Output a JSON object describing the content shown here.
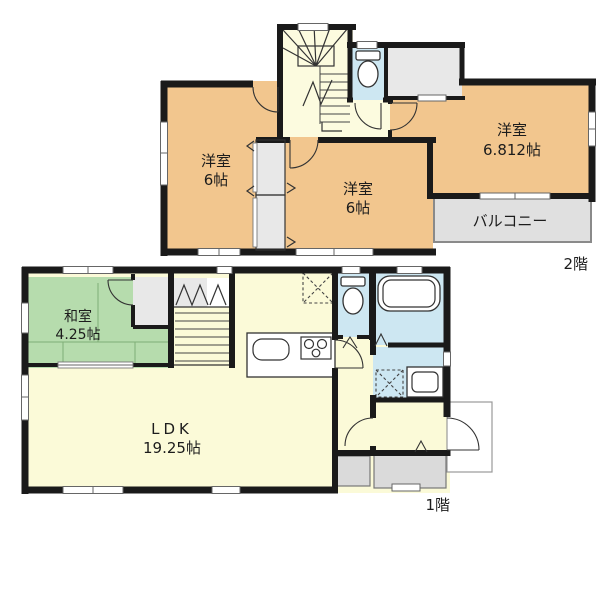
{
  "plan": {
    "floor2": {
      "floor_label": "2階",
      "room_left": {
        "name": "洋室",
        "size": "6帖"
      },
      "room_center": {
        "name": "洋室",
        "size": "6帖"
      },
      "room_right": {
        "name": "洋室",
        "size": "6.812帖"
      },
      "balcony_label": "バルコニー"
    },
    "floor1": {
      "floor_label": "1階",
      "tatami_room": {
        "name": "和室",
        "size": "4.25帖"
      },
      "ldk": {
        "name": "LDK",
        "size": "19.25帖"
      }
    }
  },
  "colors": {
    "wall": "#1a1a1a",
    "western_room": "#f2c68e",
    "hall_stairs": "#fcfbdf",
    "ldk_floor": "#fbfad8",
    "tatami_room": "#b6dcad",
    "wet_area": "#cde7f2",
    "closet": "#e8e8e8",
    "balcony": "#e0e0e0",
    "porch": "#dadada"
  },
  "icons": {
    "stairs_2f": "winder-staircase",
    "toilet_2f": "toilet",
    "stairs_1f": "straight-staircase",
    "toilet_1f": "toilet",
    "bathtub": "bathtub",
    "kitchen_sink": "kitchen-sink",
    "stove": "three-burner-stove",
    "refrigerator_space": "dashed-appliance-box",
    "washer_space": "dashed-appliance-box",
    "vanity": "vanity-sink"
  }
}
